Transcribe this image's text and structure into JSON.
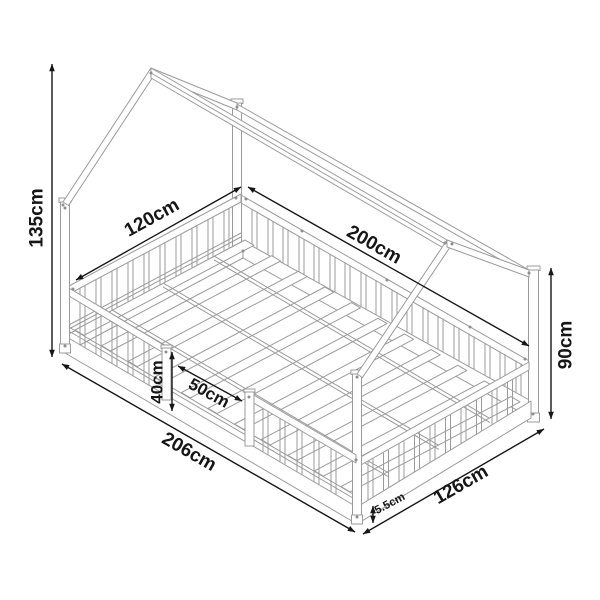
{
  "diagram": {
    "subject": "house-frame floor bed with guard rails, isometric dimension drawing",
    "unit": "cm",
    "dimensions": [
      {
        "name": "overall-height",
        "label": "135cm"
      },
      {
        "name": "bed-width",
        "label": "120cm"
      },
      {
        "name": "lying-surface-length",
        "label": "200cm"
      },
      {
        "name": "side-post-height",
        "label": "90cm"
      },
      {
        "name": "guard-rail-height",
        "label": "40cm"
      },
      {
        "name": "entry-opening-width",
        "label": "50cm"
      },
      {
        "name": "overall-length",
        "label": "206cm"
      },
      {
        "name": "overall-width",
        "label": "126cm"
      },
      {
        "name": "base-frame-height",
        "label": "5.5cm"
      }
    ],
    "colors": {
      "background": "#ffffff",
      "structure_line": "#9b9b9b",
      "dimension_line": "#161616",
      "label_text": "#161616"
    }
  }
}
